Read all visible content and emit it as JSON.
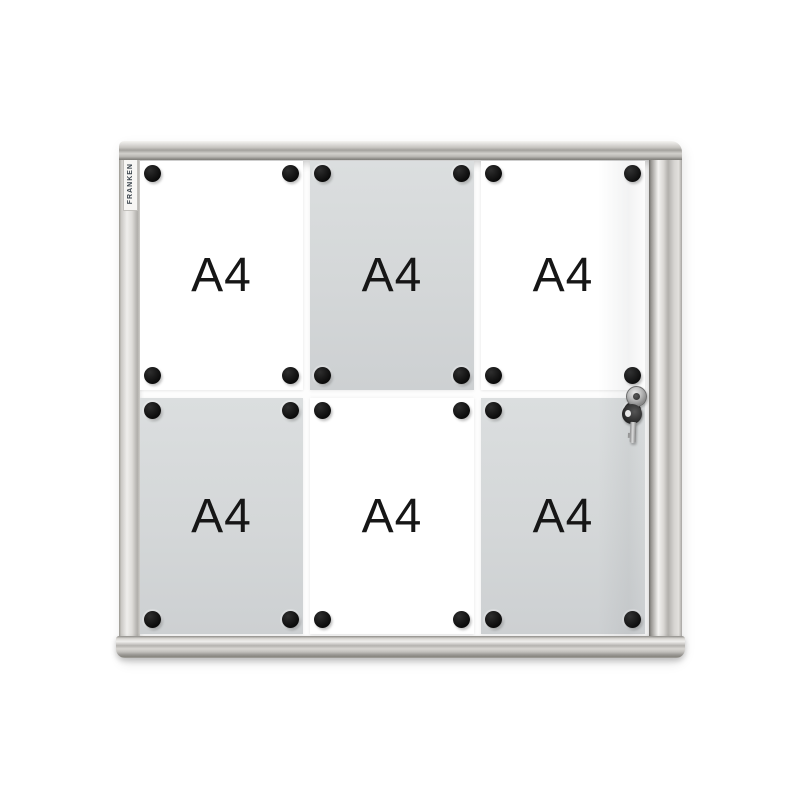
{
  "board": {
    "brand": "FRANKEN",
    "description": "Lockable magnetic display case notice board with aluminum frame",
    "rows": 2,
    "columns": 3,
    "magnets_per_sheet": 4
  },
  "sheets": [
    {
      "label": "A4",
      "position": "row1-col1",
      "shade": "white"
    },
    {
      "label": "A4",
      "position": "row1-col2",
      "shade": "gray"
    },
    {
      "label": "A4",
      "position": "row1-col3",
      "shade": "white"
    },
    {
      "label": "A4",
      "position": "row2-col1",
      "shade": "gray"
    },
    {
      "label": "A4",
      "position": "row2-col2",
      "shade": "white"
    },
    {
      "label": "A4",
      "position": "row2-col3",
      "shade": "gray"
    }
  ],
  "hardware": {
    "lock": "cylinder-lock",
    "key": "hanging-key"
  },
  "colors": {
    "frame_aluminum": "#d6d4d1",
    "sheet_white": "#ffffff",
    "sheet_gray": "#d5d8d9",
    "magnet_black": "#141414",
    "label_text": "#161616",
    "background": "#ffffff"
  }
}
